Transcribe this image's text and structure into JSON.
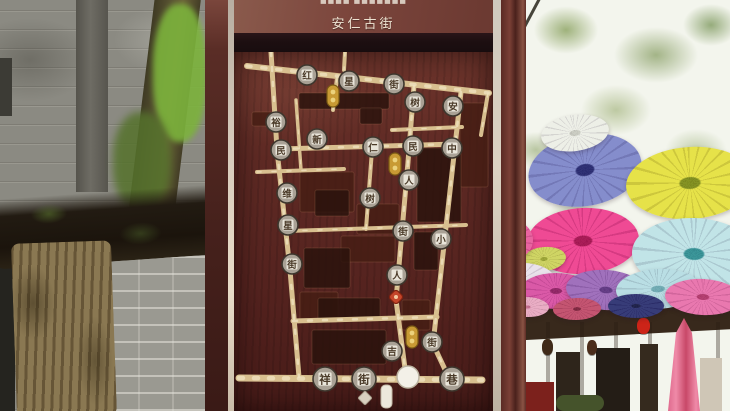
{
  "sign": {
    "top_text_cropped": "■■■■ ■■■■■■■",
    "title": "安仁古街",
    "map": {
      "streets": [
        [
          247,
          66,
          489,
          93,
          6
        ],
        [
          271,
          52,
          277,
          150,
          5
        ],
        [
          277,
          150,
          290,
          270,
          5
        ],
        [
          290,
          270,
          299,
          377,
          5
        ],
        [
          239,
          378,
          482,
          380,
          7
        ],
        [
          279,
          149,
          457,
          144,
          5
        ],
        [
          257,
          172,
          344,
          169,
          4
        ],
        [
          288,
          231,
          466,
          225,
          4
        ],
        [
          293,
          321,
          437,
          317,
          5
        ],
        [
          414,
          86,
          408,
          162,
          5
        ],
        [
          408,
          162,
          396,
          300,
          5
        ],
        [
          396,
          300,
          406,
          376,
          5
        ],
        [
          461,
          92,
          449,
          200,
          5
        ],
        [
          449,
          200,
          433,
          344,
          5
        ],
        [
          433,
          344,
          449,
          378,
          5
        ],
        [
          488,
          93,
          481,
          135,
          4
        ],
        [
          337,
          78,
          333,
          110,
          4
        ],
        [
          372,
          150,
          366,
          229,
          4
        ],
        [
          296,
          100,
          301,
          170,
          3.5
        ],
        [
          345,
          52,
          344,
          70,
          4
        ],
        [
          392,
          130,
          462,
          127,
          4
        ]
      ],
      "blocks": [
        [
          299,
          93,
          90,
          16
        ],
        [
          252,
          112,
          20,
          14
        ],
        [
          360,
          108,
          22,
          16
        ],
        [
          460,
          103,
          28,
          84
        ],
        [
          417,
          148,
          44,
          74
        ],
        [
          300,
          172,
          54,
          40
        ],
        [
          315,
          190,
          34,
          26
        ],
        [
          357,
          204,
          42,
          30
        ],
        [
          414,
          232,
          24,
          38
        ],
        [
          341,
          236,
          54,
          26
        ],
        [
          304,
          248,
          46,
          40
        ],
        [
          300,
          292,
          38,
          30
        ],
        [
          318,
          298,
          62,
          22
        ],
        [
          402,
          300,
          28,
          30
        ],
        [
          312,
          330,
          74,
          34
        ]
      ],
      "medallions": [
        [
          307,
          75,
          "红"
        ],
        [
          349,
          81,
          "星"
        ],
        [
          394,
          84,
          "街"
        ],
        [
          415,
          102,
          "树"
        ],
        [
          453,
          106,
          "安"
        ],
        [
          276,
          122,
          "裕"
        ],
        [
          281,
          150,
          "民"
        ],
        [
          317,
          139,
          "新"
        ],
        [
          373,
          147,
          "仁"
        ],
        [
          413,
          146,
          "民"
        ],
        [
          452,
          148,
          "中"
        ],
        [
          287,
          193,
          "维"
        ],
        [
          288,
          225,
          "星"
        ],
        [
          292,
          264,
          "街"
        ],
        [
          370,
          198,
          "树"
        ],
        [
          409,
          180,
          "人"
        ],
        [
          403,
          231,
          "街"
        ],
        [
          441,
          239,
          "小"
        ],
        [
          397,
          275,
          "人"
        ],
        [
          432,
          342,
          "街"
        ],
        [
          392,
          351,
          "吉"
        ],
        [
          325,
          379,
          "祥",
          12
        ],
        [
          364,
          379,
          "街",
          12
        ],
        [
          452,
          379,
          "巷",
          12
        ]
      ],
      "gold_markers": [
        [
          333,
          96
        ],
        [
          395,
          164
        ],
        [
          412,
          337
        ]
      ],
      "red_marker": [
        396,
        297
      ],
      "legend": {
        "circle": [
          408,
          377,
          11
        ],
        "pill": [
          381,
          385,
          11,
          23
        ],
        "diamond": [
          365,
          398,
          10
        ]
      }
    }
  },
  "background": {
    "umbrellas": [
      [
        585,
        170,
        57,
        36,
        -10,
        "#7d86c9",
        "#23266e"
      ],
      [
        690,
        183,
        64,
        36,
        -4,
        "#e4e03e",
        "#7d8c16"
      ],
      [
        583,
        241,
        56,
        33,
        -3,
        "#ee3f8d",
        "#a50f4e"
      ],
      [
        694,
        254,
        62,
        36,
        2,
        "#bde2e6",
        "#2f8f93"
      ],
      [
        544,
        259,
        22,
        12,
        -6,
        "#ccd25a",
        "#9aa42e"
      ],
      [
        575,
        133,
        34,
        18,
        -8,
        "#eceee6",
        "#c8cabf"
      ],
      [
        505,
        240,
        28,
        22,
        0,
        "#e85a9a",
        "#c03070"
      ],
      [
        515,
        283,
        40,
        20,
        -5,
        "#e8e0ea",
        "#b8a8c0"
      ],
      [
        556,
        291,
        36,
        18,
        0,
        "#d84fa2",
        "#8f1f62"
      ],
      [
        606,
        290,
        40,
        20,
        4,
        "#9a68b8",
        "#5c3380"
      ],
      [
        658,
        289,
        42,
        20,
        -3,
        "#b5dce2",
        "#6aa8b0"
      ],
      [
        703,
        297,
        38,
        18,
        3,
        "#e870aa",
        "#b03468"
      ],
      [
        636,
        306,
        28,
        12,
        0,
        "#2b3070",
        "#161a44"
      ],
      [
        577,
        309,
        24,
        11,
        -2,
        "#c04a68",
        "#7a1f38"
      ],
      [
        527,
        307,
        22,
        10,
        2,
        "#e8a8c0",
        "#c06888"
      ],
      [
        522,
        404,
        26,
        13,
        0,
        "#e85898",
        "#a02458"
      ]
    ],
    "lanterns": [
      [
        643,
        318,
        13,
        16,
        "#cc2418"
      ],
      [
        592,
        340,
        10,
        15,
        "#4a2c1a"
      ],
      [
        547,
        339,
        11,
        16,
        "#3f2a18"
      ]
    ]
  },
  "colors": {
    "sign-wood": "#5d2a24",
    "street-tan": "#d8bf8f",
    "street-light": "#f0e4c2",
    "medal-rim": "#3d362d",
    "medal-face": "#a9a195",
    "medal-plate": "#e9e5da",
    "gold-badge": "#c89a34",
    "marker-red": "#c4452a",
    "block-dark": "#2a120c",
    "block-brown": "#451d13",
    "sky": "#f3f5ed",
    "wall-gray": "#8b8a82",
    "moss-green": "#7cb33c",
    "trunk-tan": "#8a7852"
  }
}
